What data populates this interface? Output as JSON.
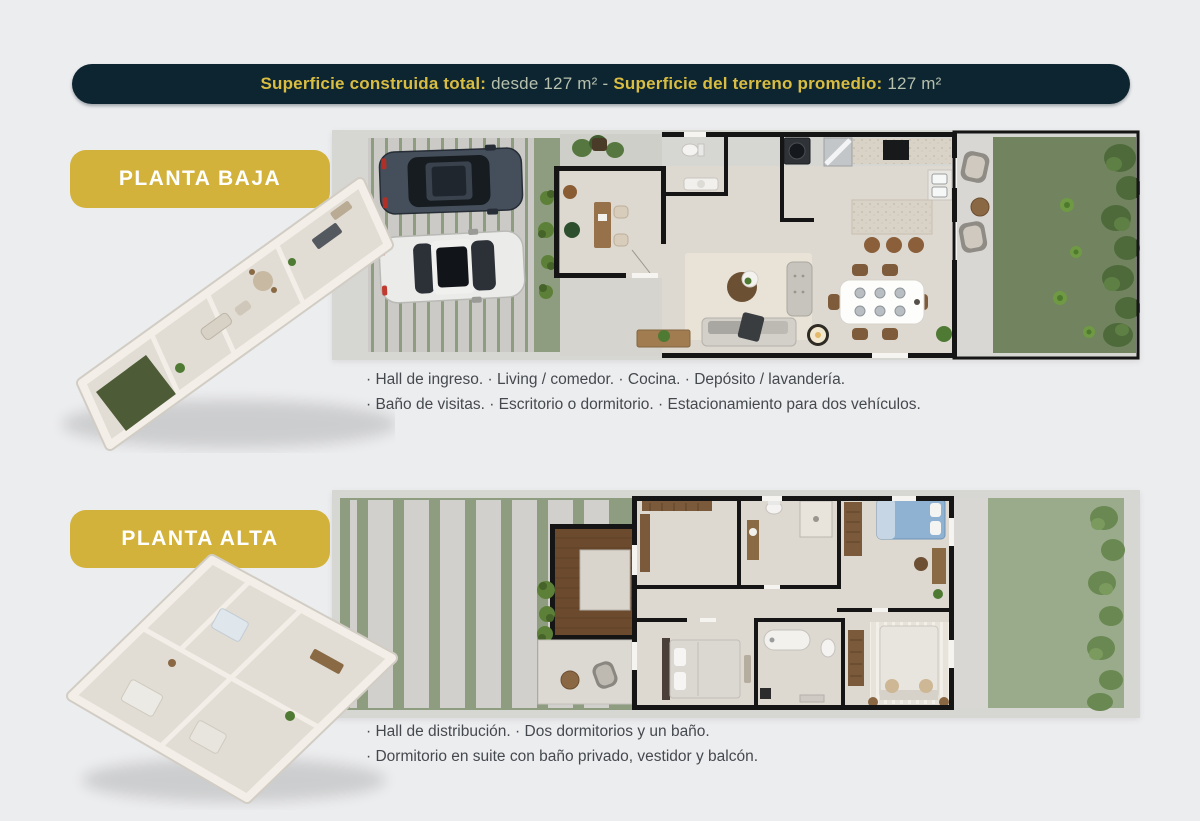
{
  "banner": {
    "built_label": "Superficie construida total:",
    "built_value": "desde 127 m²",
    "separator": "-",
    "terrain_label": "Superficie del terreno promedio:",
    "terrain_value": "127 m²"
  },
  "sections": [
    {
      "badge": "PLANTA BAJA",
      "features": [
        "· Hall de ingreso. · Living / comedor.  · Cocina. · Depósito / lavandería.",
        "· Baño de visitas.  · Escritorio o dormitorio. · Estacionamiento para dos vehículos."
      ]
    },
    {
      "badge": "PLANTA ALTA",
      "features": [
        "· Hall de distribución. · Dos dormitorios y un baño.",
        "· Dormitorio en suite con baño privado, vestidor y  balcón."
      ]
    }
  ],
  "colors": {
    "page_background": "#ecedef",
    "banner_background": "#0d2431",
    "banner_accent": "#d9bd41",
    "banner_muted": "#b6c0ac",
    "badge_gold": "#d3b23c",
    "badge_text": "#ffffff",
    "feature_text": "#45494e",
    "lawn_dark": "#71835f",
    "lawn_light": "#9aab8c",
    "sage": "#8e9c80",
    "paver_gray": "#cbcac6",
    "concrete": "#d6d6d2",
    "interior_floor": "#ddd8d0",
    "wall_black": "#151515",
    "wood_deck": "#6b4a2e"
  }
}
